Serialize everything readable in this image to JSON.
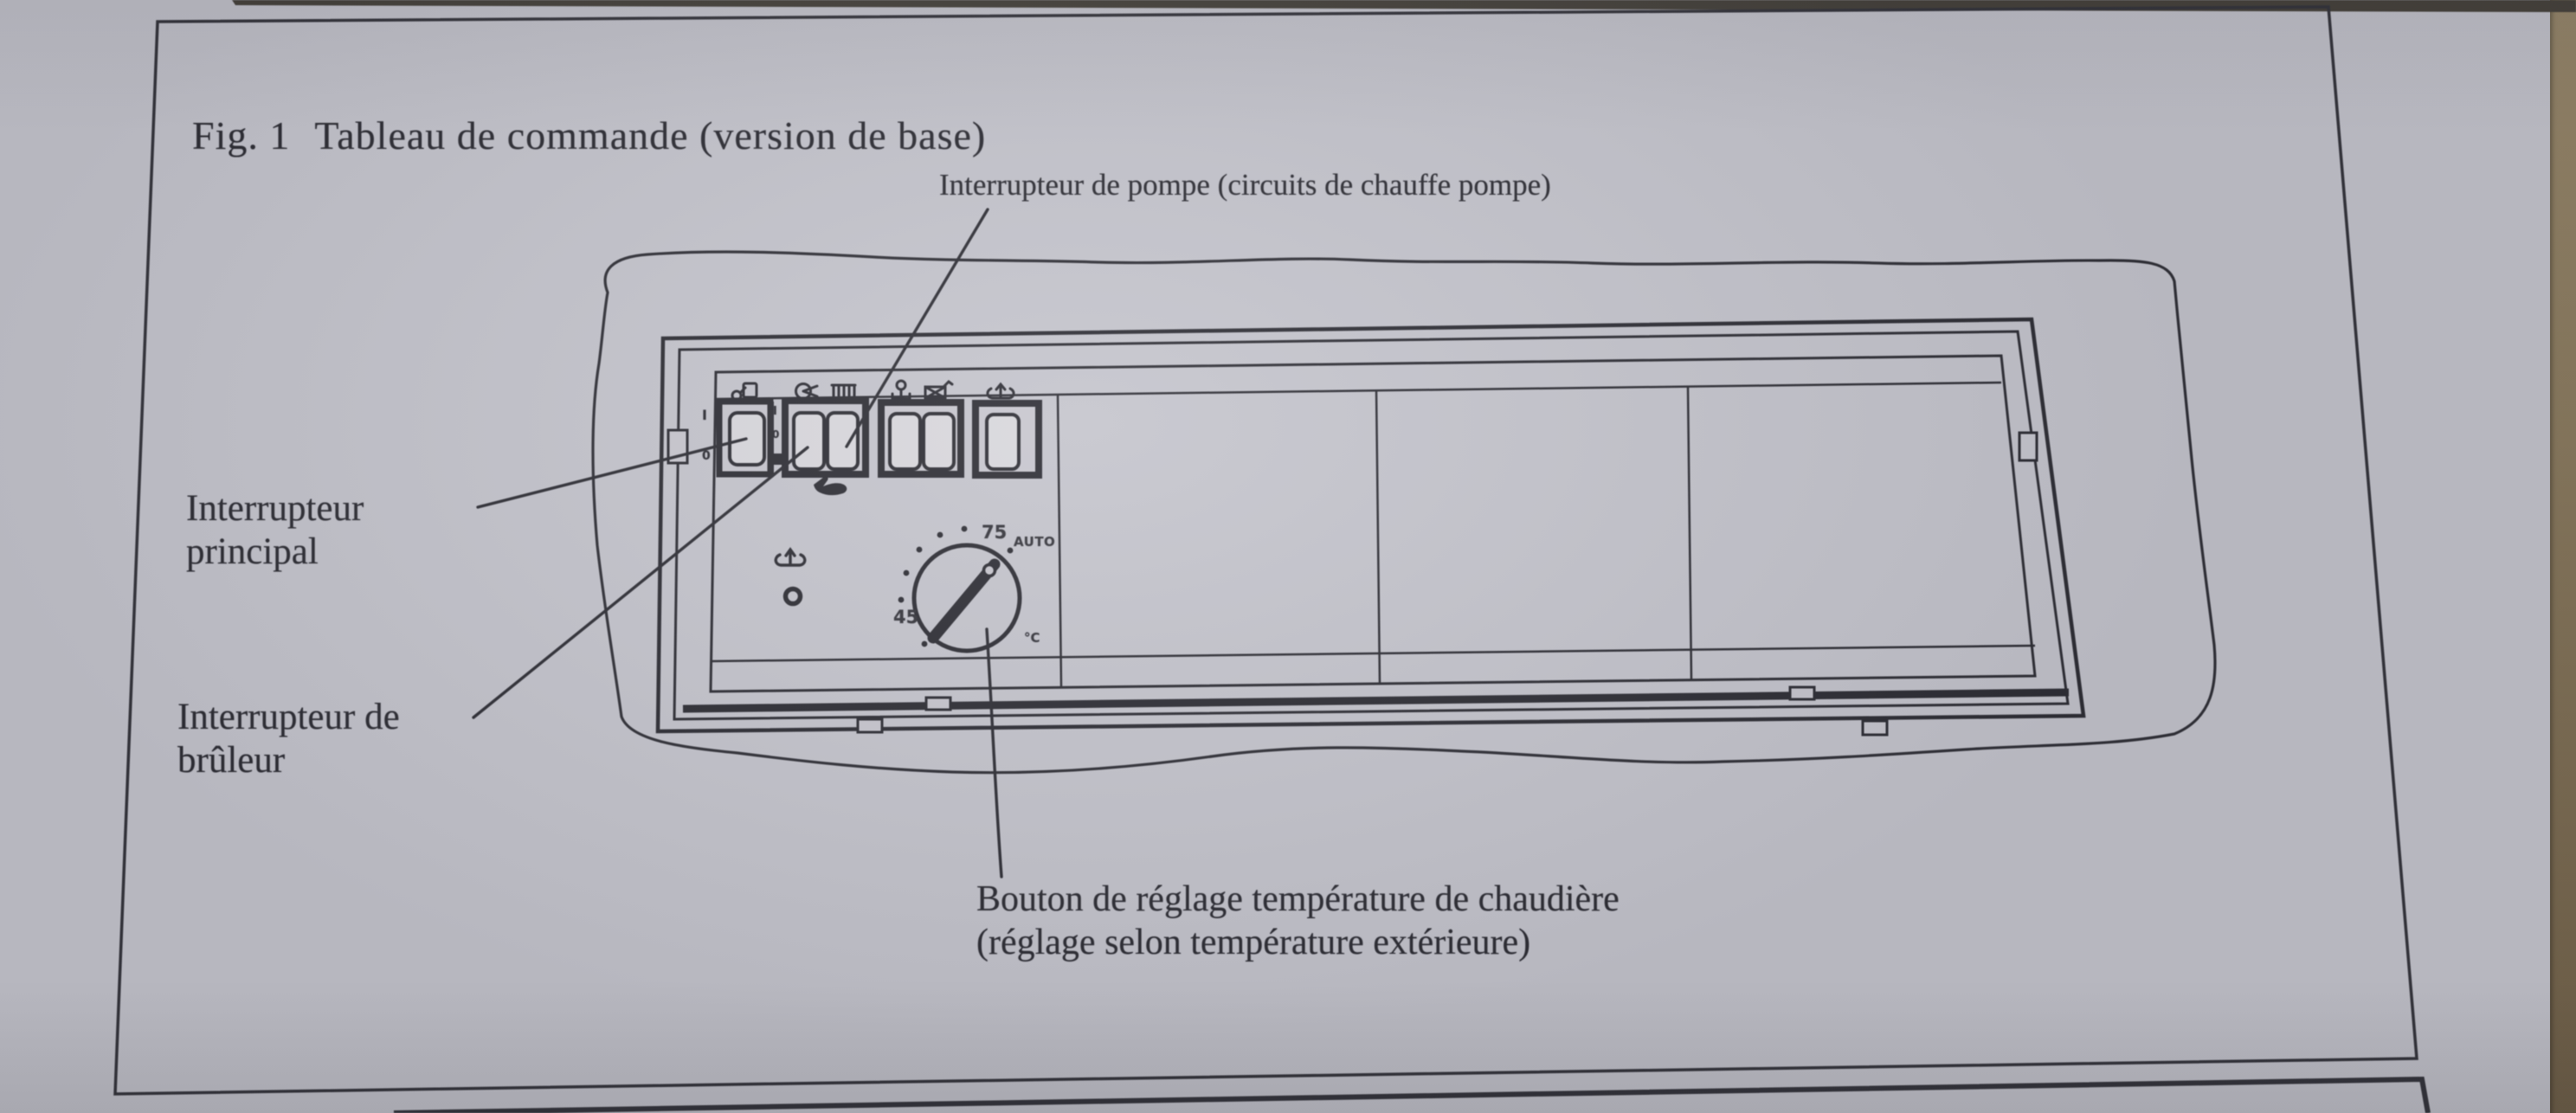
{
  "figure": {
    "title_prefix": "Fig. 1",
    "title_text": "Tableau de commande (version de base)"
  },
  "callouts": {
    "pump_switch": "Interrupteur de pompe (circuits de chauffe pompe)",
    "main_switch_line1": "Interrupteur",
    "main_switch_line2": "principal",
    "burner_switch_line1": "Interrupteur de",
    "burner_switch_line2": "brûleur",
    "boiler_knob_line1": "Bouton de réglage température de chaudière",
    "boiler_knob_line2": "(réglage selon température extérieure)"
  },
  "panel": {
    "dial": {
      "max_label": "75",
      "min_label": "45",
      "auto_label": "AUTO",
      "unit_label": "°C"
    },
    "main_switch_markings": {
      "on": "I",
      "off": "0"
    },
    "aux_switch_markings": {
      "on": "I",
      "off": "0"
    },
    "icons": [
      "power-plug-icon",
      "pump-icon",
      "radiator-icon",
      "temperature-probe-icon",
      "flue-crossed-box-icon",
      "boiler-temperature-icon-small",
      "boiler-temperature-icon-large",
      "indicator-lamp-icon",
      "hand-pointer-icon"
    ]
  },
  "colors": {
    "ink": "#2d2d34",
    "paper": "#c7c6ce",
    "paper_shadow": "#aaa49e",
    "table_edge": "#8a7a5e",
    "photo_edge": "#45413a"
  }
}
